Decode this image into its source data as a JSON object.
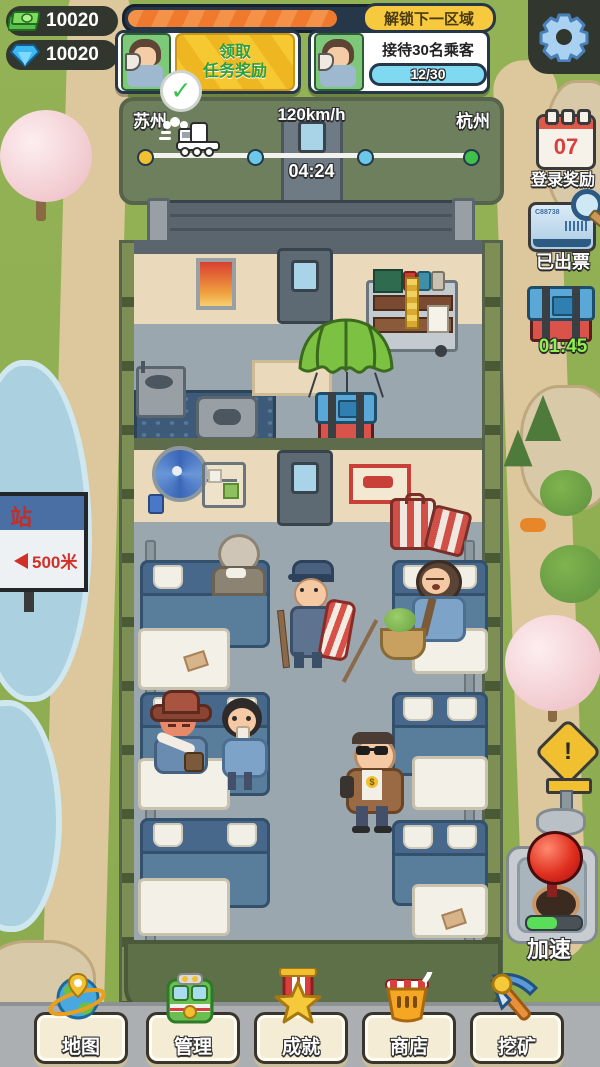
{
  "currency": {
    "money": "10020",
    "gems": "10020"
  },
  "unlock": {
    "label": "解锁下一区域",
    "progress_pct": 57
  },
  "tasks": {
    "claim": {
      "line1": "领取",
      "line2": "任务奖励",
      "check": "✓"
    },
    "serve": {
      "title": "接待30名乘客",
      "progress": "12/30"
    }
  },
  "route": {
    "from": "苏州",
    "speed": "120km/h",
    "to": "杭州",
    "timer": "04:24"
  },
  "sidebar": {
    "calendar_day": "07",
    "login_label": "登录奖励",
    "ticket_code": "C88738",
    "ticket_label": "已出票",
    "crate_timer": "01:45",
    "warning_mark": "!",
    "boost_label": "加速"
  },
  "sign": {
    "station_text": "站",
    "distance": "500米"
  },
  "nav": {
    "items": [
      {
        "label": "地图"
      },
      {
        "label": "管理"
      },
      {
        "label": "成就"
      },
      {
        "label": "商店"
      },
      {
        "label": "挖矿"
      }
    ]
  }
}
